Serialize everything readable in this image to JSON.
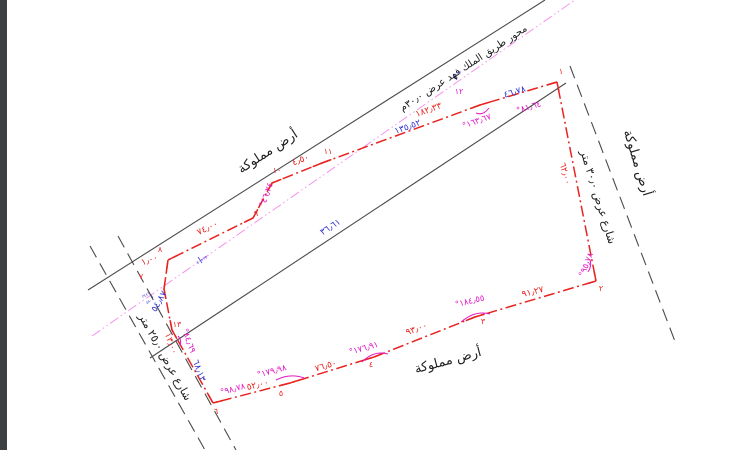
{
  "drawing_colors": {
    "boundary_red": "#e8231f",
    "dimension_blue": "#3033cf",
    "angle_magenta": "#e415c8",
    "centerline_pink": "#f593f0",
    "line_black": "#4a4a4a",
    "text_black": "#1c1c1c",
    "page_edge": "#3d4043"
  },
  "label_groups": [
    {
      "group": "area-labels",
      "color": "#1c1c1c",
      "items": [
        {
          "name": "owned-land-label-top-left",
          "text": "أرض مملوكة",
          "x": 268,
          "y": 152,
          "rot": -33,
          "size": 13
        },
        {
          "name": "road-axis-label",
          "text": "محور طريق الملك فهد عرض ٣٠٫٠م",
          "x": 464,
          "y": 69,
          "rot": -33,
          "size": 10
        },
        {
          "name": "owned-land-label-right",
          "text": "أرض مملوكة",
          "x": 637,
          "y": 163,
          "rot": 73,
          "size": 13
        },
        {
          "name": "street-right-label",
          "text": "شارع عرض ٣٠٫٠ متر",
          "x": 598,
          "y": 197,
          "rot": 73,
          "size": 11
        },
        {
          "name": "street-left-label",
          "text": "شارع عرض ٢٥٫٠ متر",
          "x": 165,
          "y": 357,
          "rot": 61,
          "size": 11
        },
        {
          "name": "owned-land-label-bottom",
          "text": "أرض مملوكة",
          "x": 448,
          "y": 361,
          "rot": -15,
          "size": 13
        }
      ]
    },
    {
      "group": "red-dimensions",
      "color": "#e8231f",
      "items": [
        {
          "name": "dim-seg-12-11",
          "text": "١٨٢٫٣٣",
          "x": 429,
          "y": 111,
          "rot": -20,
          "size": 9
        },
        {
          "name": "dim-seg-11-10",
          "text": "٤٫٥٠",
          "x": 301,
          "y": 161,
          "rot": -21,
          "size": 9
        },
        {
          "name": "dim-seg-9-8",
          "text": "٧٤٫٠٠",
          "x": 208,
          "y": 229,
          "rot": -26,
          "size": 9
        },
        {
          "name": "dim-seg-8-7",
          "text": "١٫٠٠",
          "x": 150,
          "y": 261,
          "rot": -20,
          "size": 9
        },
        {
          "name": "dim-seg-13",
          "text": "١٣٫٠٠",
          "x": 170,
          "y": 344,
          "rot": 70,
          "size": 9
        },
        {
          "name": "dim-seg-2-1",
          "text": "٦٢٫٠٠",
          "x": 564,
          "y": 174,
          "rot": 75,
          "size": 9
        },
        {
          "name": "dim-seg-6-5",
          "text": "٥٢٫٠٠",
          "x": 258,
          "y": 386,
          "rot": -14,
          "size": 9
        },
        {
          "name": "dim-seg-5-4",
          "text": "٧٦٫٥٠",
          "x": 326,
          "y": 367,
          "rot": -16,
          "size": 9
        },
        {
          "name": "dim-seg-4-3",
          "text": "٩٣٫٠٠",
          "x": 417,
          "y": 330,
          "rot": -20,
          "size": 9
        },
        {
          "name": "dim-seg-3-2",
          "text": "٩١٫٢٧",
          "x": 533,
          "y": 293,
          "rot": -14,
          "size": 9
        }
      ]
    },
    {
      "group": "blue-dimensions",
      "color": "#3033cf",
      "items": [
        {
          "name": "dim-blue-135-52",
          "text": "١٣٥٫٥٢",
          "x": 408,
          "y": 128,
          "rot": -20,
          "size": 9
        },
        {
          "name": "dim-blue-46-78",
          "text": "٤٦٫٧٨",
          "x": 515,
          "y": 93,
          "rot": -17,
          "size": 9
        },
        {
          "name": "dim-blue-36-61",
          "text": "٣٦٫٦١",
          "x": 331,
          "y": 228,
          "rot": -33,
          "size": 9
        },
        {
          "name": "dim-blue-54-87",
          "text": "٥٤٫٨٧",
          "x": 160,
          "y": 302,
          "rot": -60,
          "size": 9
        },
        {
          "name": "dim-blue-68-13",
          "text": "٦٨٫١٣",
          "x": 198,
          "y": 371,
          "rot": 70,
          "size": 9
        }
      ]
    },
    {
      "group": "magenta-angles",
      "color": "#e415c8",
      "items": [
        {
          "name": "angle-at-12",
          "text": "١٦٣٫٦٧°",
          "x": 477,
          "y": 122,
          "rot": -20,
          "size": 8.5
        },
        {
          "name": "angle-at-1",
          "text": "٨١٫٦٤°",
          "x": 529,
          "y": 108,
          "rot": -17,
          "size": 8.5
        },
        {
          "name": "angle-at-10",
          "text": "٤٦٫٢٤°",
          "x": 267,
          "y": 195,
          "rot": -70,
          "size": 8.5
        },
        {
          "name": "angle-at-13",
          "text": "٨٤٫٦٩°",
          "x": 188,
          "y": 341,
          "rot": 70,
          "size": 8.5
        },
        {
          "name": "angle-at-6",
          "text": "٩٨٫٧٨°",
          "x": 233,
          "y": 390,
          "rot": -15,
          "size": 8.5
        },
        {
          "name": "angle-at-5",
          "text": "١٧٩٫٩٨°",
          "x": 272,
          "y": 372,
          "rot": -15,
          "size": 8.5
        },
        {
          "name": "angle-at-4",
          "text": "١٧٦٫٩١°",
          "x": 364,
          "y": 349,
          "rot": -16,
          "size": 8.5
        },
        {
          "name": "angle-at-3",
          "text": "١٨٤٫٥٥°",
          "x": 470,
          "y": 302,
          "rot": -14,
          "size": 8.5
        },
        {
          "name": "angle-at-2",
          "text": "٩٥٫٧٨°",
          "x": 587,
          "y": 265,
          "rot": -68,
          "size": 8.5
        }
      ]
    },
    {
      "group": "point-markers",
      "color": "#e8231f",
      "items": [
        {
          "name": "point-1",
          "text": "١",
          "x": 561,
          "y": 72,
          "rot": 0,
          "size": 8
        },
        {
          "name": "point-2",
          "text": "٢",
          "x": 601,
          "y": 289,
          "rot": 0,
          "size": 8
        },
        {
          "name": "point-3",
          "text": "٣",
          "x": 483,
          "y": 322,
          "rot": 0,
          "size": 8
        },
        {
          "name": "point-4",
          "text": "٤",
          "x": 371,
          "y": 365,
          "rot": 0,
          "size": 8
        },
        {
          "name": "point-5",
          "text": "٥",
          "x": 281,
          "y": 394,
          "rot": 0,
          "size": 8
        },
        {
          "name": "point-6",
          "text": "٦",
          "x": 216,
          "y": 412,
          "rot": 0,
          "size": 8
        },
        {
          "name": "point-7",
          "text": "٧",
          "x": 141,
          "y": 277,
          "rot": 0,
          "size": 8
        },
        {
          "name": "point-8",
          "text": "٨",
          "x": 160,
          "y": 250,
          "rot": 0,
          "size": 8
        },
        {
          "name": "point-9",
          "text": "٩",
          "x": 256,
          "y": 214,
          "rot": 0,
          "size": 8
        },
        {
          "name": "point-10",
          "text": "١٠",
          "x": 277,
          "y": 171,
          "rot": 0,
          "size": 8
        },
        {
          "name": "point-11",
          "text": "١١",
          "x": 328,
          "y": 152,
          "rot": 0,
          "size": 8
        },
        {
          "name": "point-12",
          "text": "١٢",
          "x": 459,
          "y": 92,
          "rot": 0,
          "size": 8,
          "color": "#e415c8"
        },
        {
          "name": "point-13",
          "text": "١٣",
          "x": 177,
          "y": 325,
          "rot": 0,
          "size": 8
        }
      ]
    },
    {
      "group": "station-markers",
      "color": "#4040d8",
      "items": [
        {
          "name": "station-marker-1",
          "text": "٢٥+٠٠",
          "x": 456,
          "y": 75,
          "rot": -33,
          "size": 4
        },
        {
          "name": "station-marker-2",
          "text": "٢٥+٥٠",
          "x": 202,
          "y": 260,
          "rot": -33,
          "size": 4
        },
        {
          "name": "station-marker-3a",
          "text": "٣٤٤٢",
          "x": 146,
          "y": 295,
          "rot": -33,
          "size": 4
        },
        {
          "name": "station-marker-3b",
          "text": "٥٨٠٠",
          "x": 150,
          "y": 301,
          "rot": -33,
          "size": 4
        }
      ]
    }
  ]
}
